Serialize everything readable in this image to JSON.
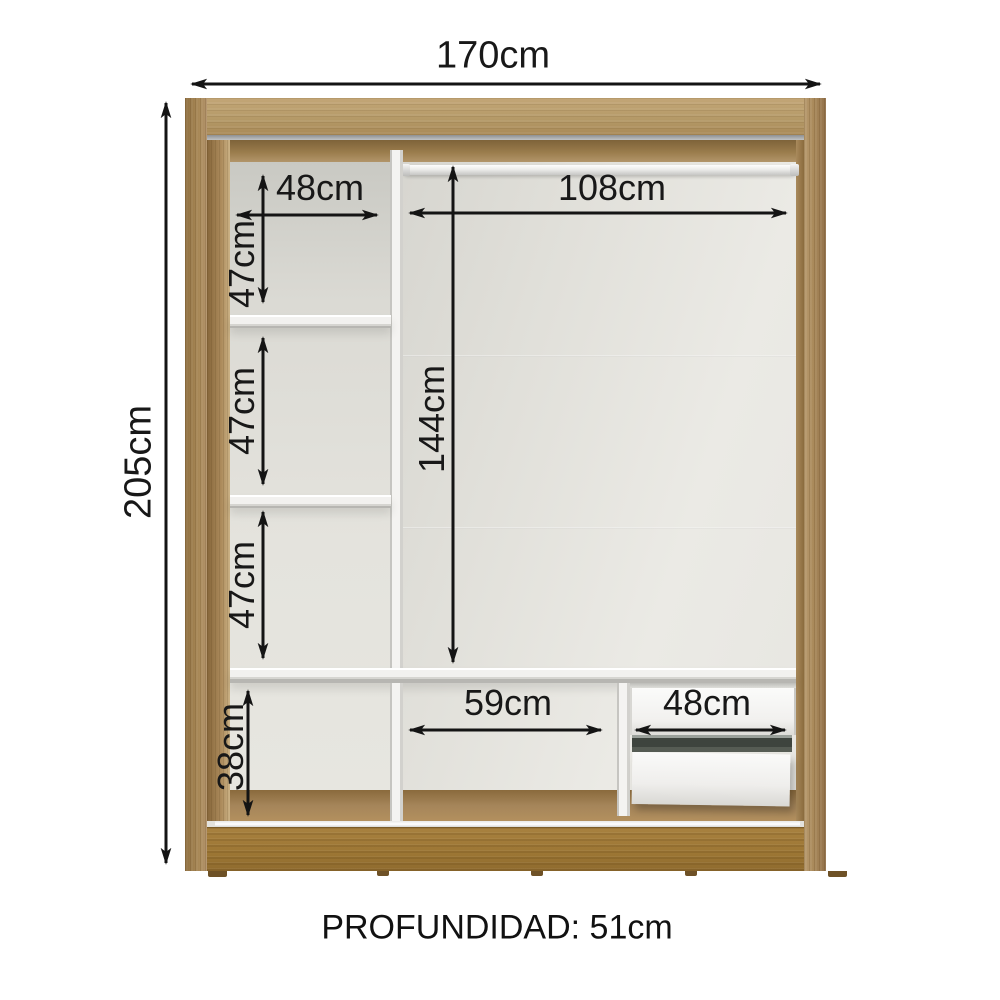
{
  "diagram": {
    "type": "wardrobe-internal-dimensions",
    "depth_label": "PROFUNDIDAD: 51cm",
    "colors": {
      "wood_frame": "#b09066",
      "wood_base": "#9c7634",
      "interior_back": "#e3e2dd",
      "panel_white": "#f3f2f0",
      "dimension_line": "#181818"
    },
    "dimensions": {
      "total_width": "170cm",
      "total_height": "205cm",
      "left_column_width": "48cm",
      "left_compartment_heights": [
        "47cm",
        "47cm",
        "47cm"
      ],
      "rod_section_width": "108cm",
      "main_section_height": "144cm",
      "bottom_section_height": "38cm",
      "middle_bottom_width": "59cm",
      "drawer_width": "48cm"
    }
  }
}
